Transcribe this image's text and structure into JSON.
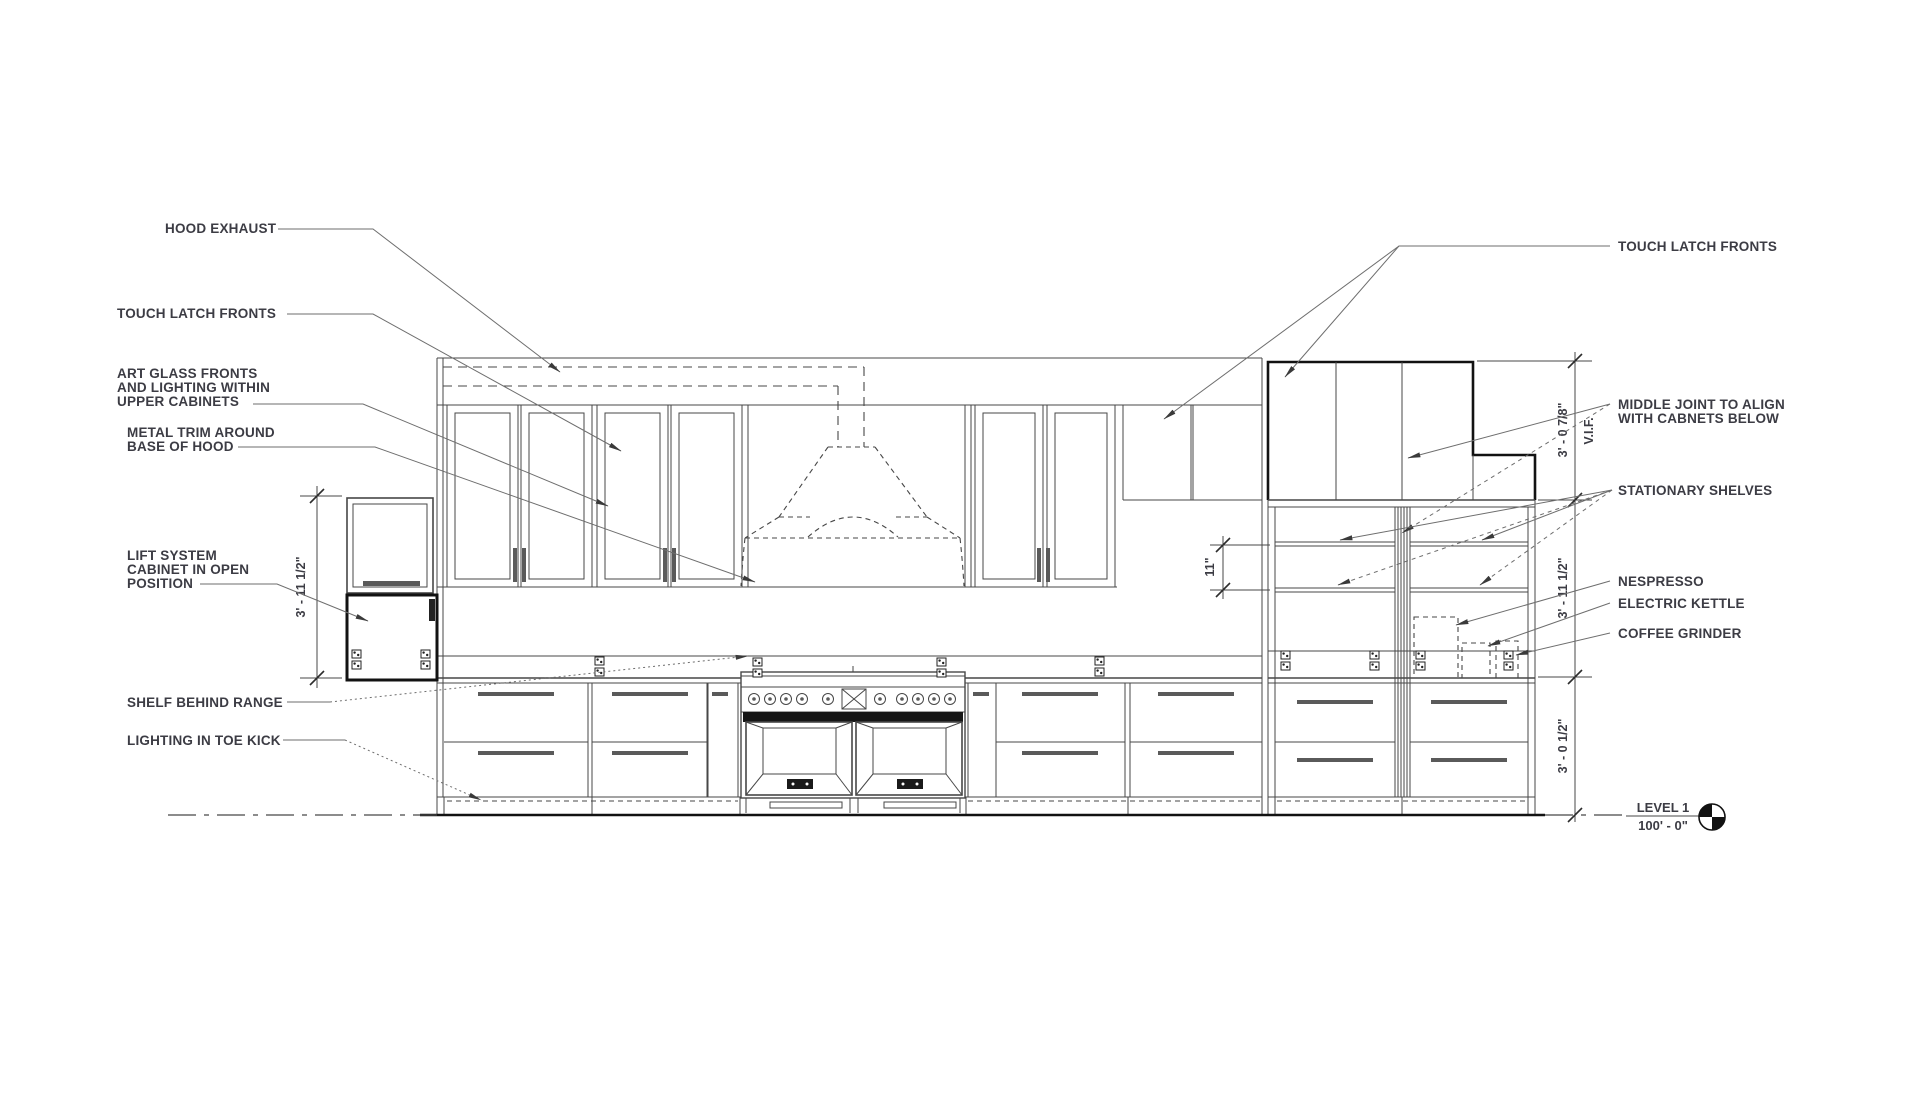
{
  "title": "Kitchen Elevation Drawing",
  "labels_left": {
    "hood_exhaust": "HOOD EXHAUST",
    "touch_latch": "TOUCH LATCH FRONTS",
    "art_glass_line1": "ART GLASS FRONTS",
    "art_glass_line2": "AND LIGHTING WITHIN",
    "art_glass_line3": "UPPER CABINETS",
    "metal_trim_line1": "METAL TRIM AROUND",
    "metal_trim_line2": "BASE OF HOOD",
    "lift_system_line1": "LIFT SYSTEM",
    "lift_system_line2": "CABINET IN OPEN",
    "lift_system_line3": "POSITION",
    "shelf_behind_range": "SHELF BEHIND RANGE",
    "lighting_toe_kick": "LIGHTING IN TOE KICK"
  },
  "labels_right": {
    "touch_latch": "TOUCH LATCH FRONTS",
    "middle_joint_line1": "MIDDLE JOINT TO ALIGN",
    "middle_joint_line2": "WITH CABNETS BELOW",
    "stationary_shelves": "STATIONARY SHELVES",
    "nespresso": "NESPRESSO",
    "electric_kettle": "ELECTRIC KETTLE",
    "coffee_grinder": "COFFEE GRINDER"
  },
  "dimensions": {
    "lift_cabinet_height": "3' - 11 1/2\"",
    "upper_cabinet_height": "3' - 0 7/8\"",
    "vif": "V.I.F.",
    "middle_section_height": "3' - 11 1/2\"",
    "base_cabinet_height": "3' - 0 1/2\"",
    "shelf_spacing": "11\""
  },
  "level_marker": {
    "name": "LEVEL 1",
    "elevation": "100' - 0\""
  },
  "colors": {
    "background": "#ffffff",
    "line": "#474747",
    "bold_line": "#121212",
    "leader": "#6e6e6e",
    "text": "#3c3c44"
  }
}
